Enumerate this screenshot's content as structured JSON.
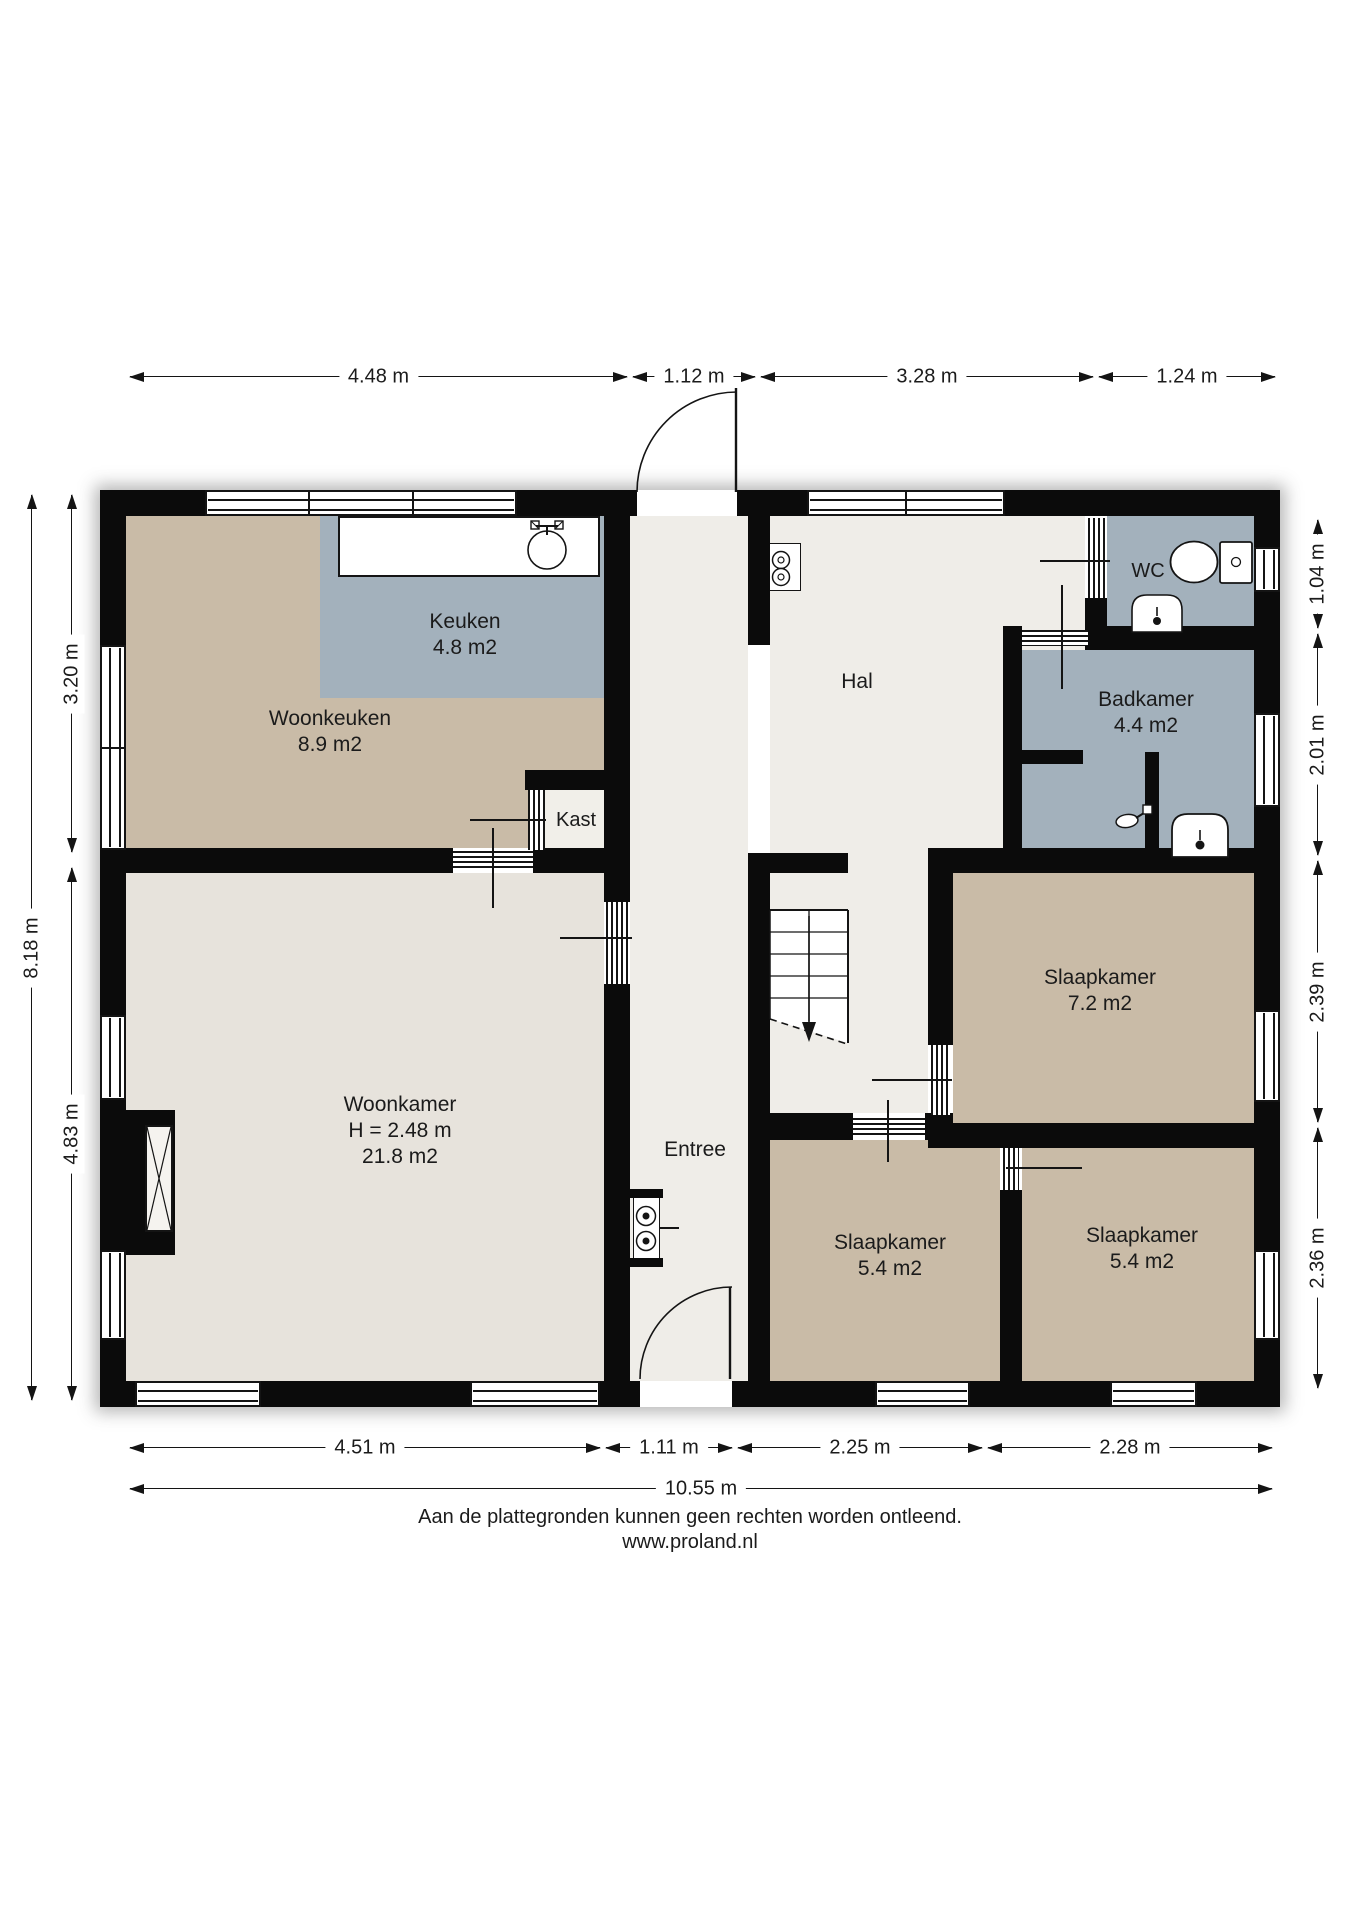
{
  "rooms": {
    "woonkeuken": {
      "name": "Woonkeuken",
      "area": "8.9 m2"
    },
    "keuken": {
      "name": "Keuken",
      "area": "4.8 m2"
    },
    "kast": {
      "name": "Kast"
    },
    "hal": {
      "name": "Hal"
    },
    "entree": {
      "name": "Entree"
    },
    "wc": {
      "name": "WC"
    },
    "badkamer": {
      "name": "Badkamer",
      "area": "4.4 m2"
    },
    "woonkamer": {
      "name": "Woonkamer",
      "ceiling_height": "H = 2.48 m",
      "area": "21.8 m2"
    },
    "slaapkamer_7_2": {
      "name": "Slaapkamer",
      "area": "7.2 m2"
    },
    "slaapkamer_mid": {
      "name": "Slaapkamer",
      "area": "5.4 m2"
    },
    "slaapkamer_right": {
      "name": "Slaapkamer",
      "area": "5.4 m2"
    }
  },
  "dimensions": {
    "top": [
      "4.48 m",
      "1.12 m",
      "3.28 m",
      "1.24 m"
    ],
    "bottom": [
      "4.51 m",
      "1.11 m",
      "2.25 m",
      "2.28 m"
    ],
    "bottom_total": "10.55 m",
    "left": [
      "3.20 m",
      "4.83 m"
    ],
    "left_total": "8.18 m",
    "right": [
      "1.04 m",
      "2.01 m",
      "2.39 m",
      "2.36 m"
    ]
  },
  "footer": {
    "disclaimer": "Aan de plattegronden kunnen geen rechten worden ontleend.",
    "website": "www.proland.nl"
  },
  "colors": {
    "wall": "#0b0b0b",
    "floor_tan": "#c9bba7",
    "floor_blue": "#a3b1bc",
    "floor_living": "#e7e3dc",
    "floor_hall": "#efede8",
    "floor_closet": "#f1efe9"
  }
}
